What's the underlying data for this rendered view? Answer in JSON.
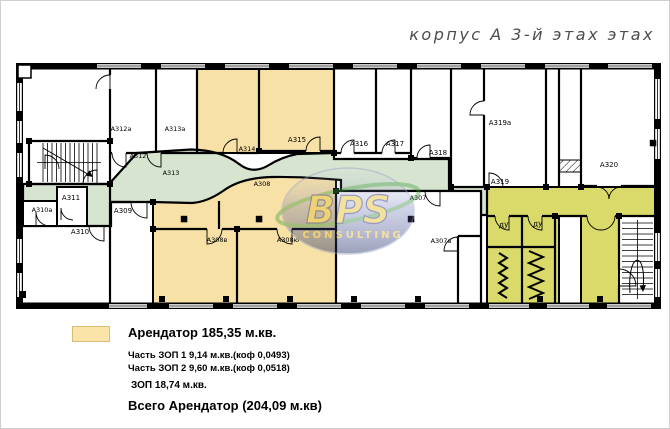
{
  "title": "корпус А 3-й этах этах",
  "watermark": {
    "brand": "BPS",
    "subtitle": "CONSULTING"
  },
  "legend": {
    "tenant": "Арендатор 185,35 м.кв.",
    "zop1": "Часть ЗОП 1 9,14 м.кв.(коф 0,0493)",
    "zop2": "Часть ЗОП 2 9,60 м.кв.(коф 0,0518)",
    "zop_total": "ЗОП 18,74 м.кв.",
    "grand_total": "Всего Арендатор  (204,09 м.кв)"
  },
  "colors": {
    "tenant_fill": "#f7e1a6",
    "zop1_fill": "#d7e5d0",
    "zop2_fill": "#d9da69",
    "legend_swatch": "#fbe4a8",
    "wall": "#000000",
    "watermark_gold": "#e8c23a",
    "watermark_navy": "#26307a",
    "watermark_green": "#3f9b3f"
  },
  "rooms": {
    "a310a": "A310а",
    "a311": "A311",
    "a310": "A310",
    "a309": "A309",
    "a312a": "A312а",
    "a312": "A312",
    "a313a": "A313а",
    "a313": "A313",
    "a314": "A314",
    "a315": "A315",
    "a316": "A316",
    "a317": "A317",
    "a318": "A318",
    "a319a": "A319а",
    "a319": "A319",
    "a320": "A320",
    "a307": "A307",
    "a307a": "A307а",
    "a308": "A308",
    "a308v": "A308в",
    "a308yu": "A308ю",
    "du1": "ду",
    "du2": "ду"
  }
}
